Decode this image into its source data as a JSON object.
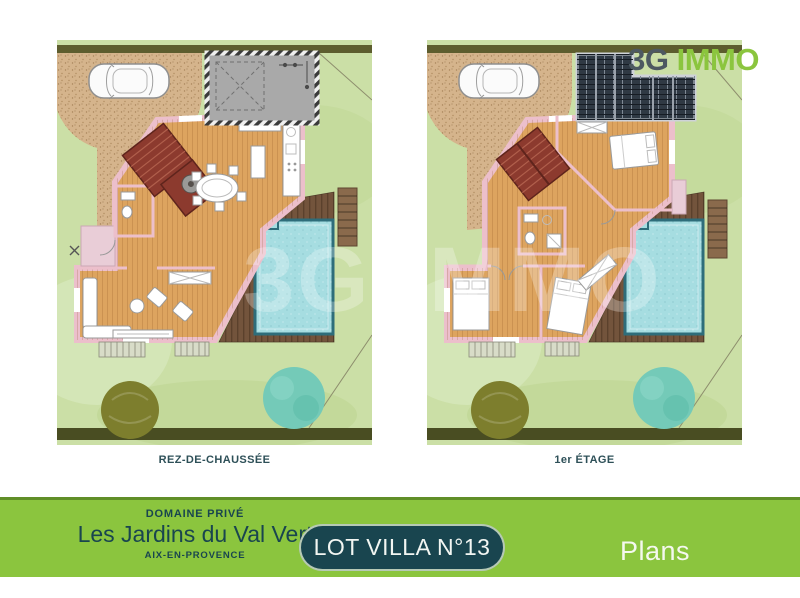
{
  "logo": {
    "prefix": "3G",
    "suffix": "IMMO"
  },
  "watermark": "3G IMMO",
  "plans": [
    {
      "label": "REZ-DE-CHAUSSÉE",
      "floor": "ground"
    },
    {
      "label": "1er ÉTAGE",
      "floor": "first"
    }
  ],
  "footer": {
    "estate_type": "DOMAINE PRIVÉ",
    "estate_name": "Les Jardins du Val Vert",
    "estate_city": "AIX-EN-PROVENCE",
    "lot_badge": "LOT VILLA N°13",
    "page_title": "Plans"
  },
  "colors": {
    "footer_green": "#8bc53e",
    "dark_teal": "#19454f",
    "logo_gray": "#4d5961",
    "logo_green": "#8bc53e",
    "lawn": "#cbdfa6",
    "hedge": "#5d5d2e",
    "hedge_dark": "#494d22",
    "driveway": "#d5b48c",
    "garage_gray": "#a9a9a9",
    "wood_floor": "#dda45f",
    "wall_pink": "#ecbfcb",
    "porch_pink": "#e9cdd7",
    "stairs_red": "#8c3a2e",
    "deck_brown": "#73543c",
    "pool_water": "#a6dde1",
    "pool_border": "#2e6d7a",
    "tree_olive": "#7d7e2d",
    "tree_teal": "#74cab8",
    "solar_dark": "#2f3944"
  }
}
